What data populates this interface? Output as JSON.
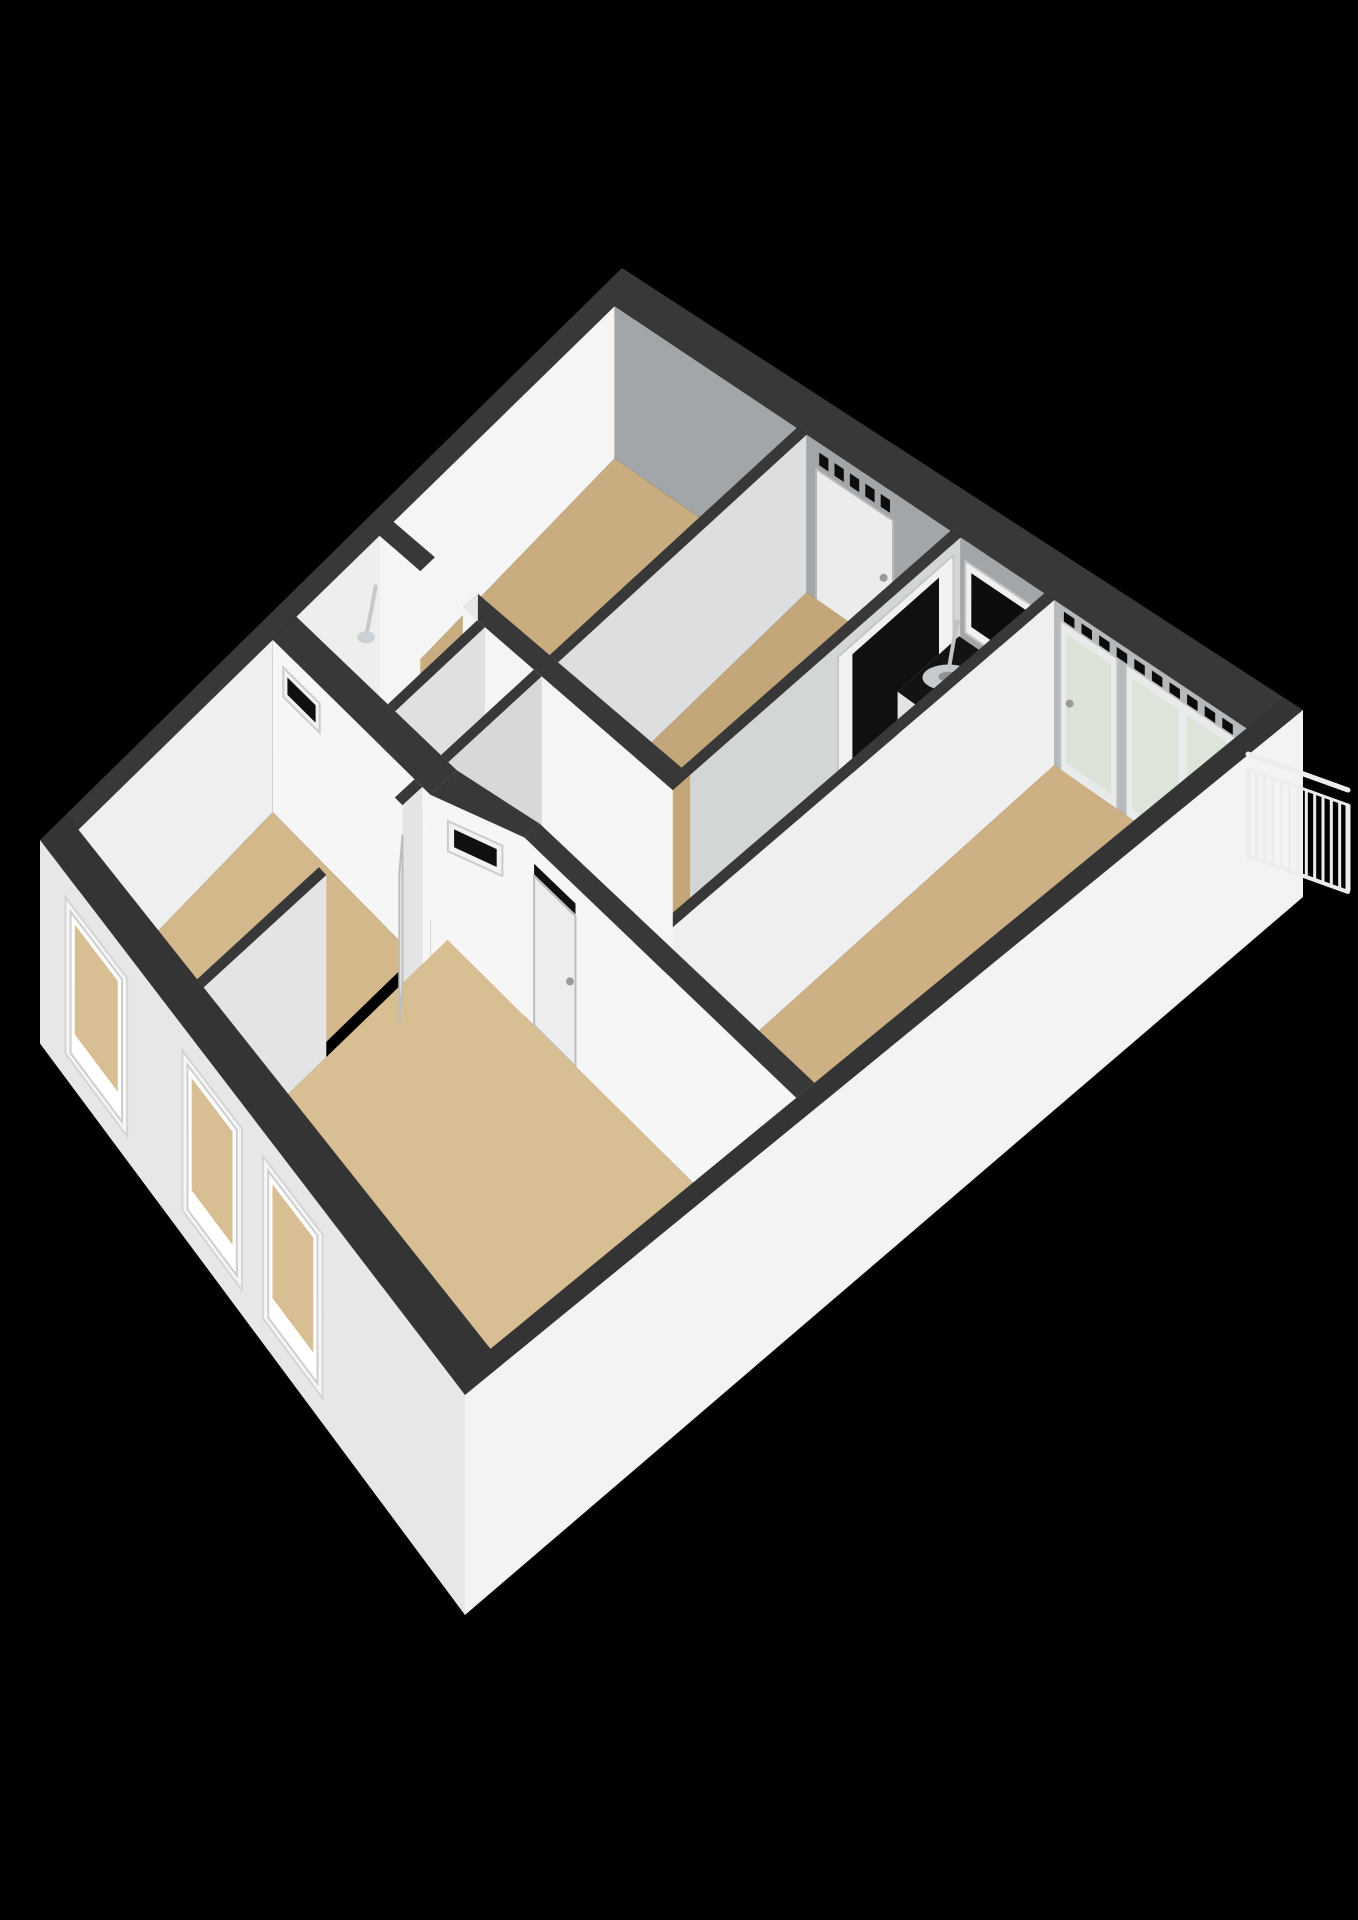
{
  "view": {
    "kind": "3d-floorplan-isometric-render",
    "canvas_width": 1358,
    "canvas_height": 1920,
    "background": "#000000"
  },
  "palette": {
    "wall_top": "#383838",
    "wall_top_exterior": "#343434",
    "wall_white": "#f5f5f5",
    "wall_gray": "#a3a6a8",
    "wall_gray_panel": "#b6b9bb",
    "facade_front": "#e7e7e7",
    "facade_side": "#f3f3f3",
    "floor_tan_back": "#c9ad80",
    "floor_tan_bedroom": "#cdb184",
    "floor_tan_front": "#d8bf93",
    "floor_shadow": "#171717",
    "counter_black": "#131313",
    "steel": "#c6cacc",
    "glass_dark": "#0d0d0d",
    "glass_light": "#dde4da",
    "door_white": "#ededed",
    "railing_white": "#ececec"
  },
  "projection": {
    "quad": {
      "A": [
        622,
        268
      ],
      "B": [
        1303,
        710
      ],
      "C": [
        465,
        1395
      ],
      "D": [
        40,
        840
      ]
    },
    "wall_heights": {
      "A": 150,
      "B": 170,
      "C": 200,
      "D": 185
    }
  },
  "scene": [
    {
      "t": "top",
      "n": "wall-top-nw",
      "r": [
        0,
        0,
        0.028,
        0.955
      ],
      "c": "#383838"
    },
    {
      "t": "top",
      "n": "wall-top-ne",
      "r": [
        0,
        0,
        1,
        0.045
      ],
      "c": "#383838"
    },
    {
      "t": "face",
      "n": "top-room-wall-nw",
      "a": [
        0.028,
        0.045
      ],
      "b": [
        0.028,
        0.42
      ],
      "z": [
        0,
        1
      ],
      "c": "#f5f5f5"
    },
    {
      "t": "face",
      "n": "top-room-wall-ne",
      "a": [
        0.028,
        0.045
      ],
      "b": [
        0.3,
        0.045
      ],
      "z": [
        0,
        1
      ],
      "c": "#a3a6a8"
    },
    {
      "t": "floor",
      "n": "top-room-floor",
      "r": [
        0.028,
        0.045,
        0.3,
        0.42
      ],
      "c": "#c9ad80"
    },
    {
      "t": "top",
      "n": "wall-top-w1",
      "r": [
        0.3,
        0.045,
        0.315,
        0.42
      ],
      "c": "#383838"
    },
    {
      "t": "face",
      "n": "wall-w1-east-face",
      "a": [
        0.315,
        0.045
      ],
      "b": [
        0.315,
        0.42
      ],
      "z": [
        0,
        1
      ],
      "c": "#dcdedf"
    },
    {
      "t": "face",
      "n": "entry-wall-ne",
      "a": [
        0.315,
        0.045
      ],
      "b": [
        0.53,
        0.045
      ],
      "z": [
        0,
        1
      ],
      "c": "#a3a6a8"
    },
    {
      "t": "face",
      "n": "entry-door",
      "a": [
        0.33,
        0.046
      ],
      "b": [
        0.445,
        0.046
      ],
      "z": [
        0.17,
        1
      ],
      "c": "#ececec",
      "s": "#b9b9b9"
    },
    {
      "t": "slots",
      "n": "entry-door-vent-slots",
      "a": [
        0.33,
        0.046
      ],
      "b": [
        0.445,
        0.046
      ],
      "z": [
        0.055,
        0.135
      ],
      "k": 5,
      "c": "#0d0d0d"
    },
    {
      "t": "disk",
      "n": "entry-door-handle",
      "at": [
        0.432,
        0.047
      ],
      "z": 0.56,
      "rx": 4,
      "ry": 4,
      "c": "#9a9a9a"
    },
    {
      "t": "floor",
      "n": "entry-hall-floor",
      "r": [
        0.315,
        0.045,
        0.53,
        0.42
      ],
      "c": "#c3a77a"
    },
    {
      "t": "top",
      "n": "wall-top-w3",
      "r": [
        0.53,
        0.045,
        0.545,
        0.42
      ],
      "c": "#383838"
    },
    {
      "t": "face",
      "n": "wall-w3-east-face",
      "a": [
        0.545,
        0.045
      ],
      "b": [
        0.545,
        0.42
      ],
      "z": [
        0,
        1
      ],
      "c": "#d3d6d7"
    },
    {
      "t": "face",
      "n": "kitchen-glass-door-frame",
      "a": [
        0.545,
        0.055
      ],
      "b": [
        0.545,
        0.215
      ],
      "z": [
        0.07,
        1
      ],
      "c": "#f1f1f1",
      "s": "#c6c6c6"
    },
    {
      "t": "face",
      "n": "kitchen-glass-door-glass",
      "a": [
        0.545,
        0.075
      ],
      "b": [
        0.545,
        0.195
      ],
      "z": [
        0.13,
        0.9
      ],
      "c": "#101010"
    },
    {
      "t": "face",
      "n": "kitchen-wall-ne",
      "a": [
        0.545,
        0.045
      ],
      "b": [
        0.67,
        0.045
      ],
      "z": [
        0,
        1
      ],
      "c": "#a3a6a8"
    },
    {
      "t": "face",
      "n": "kitchen-window-frame",
      "a": [
        0.553,
        0.046
      ],
      "b": [
        0.665,
        0.046
      ],
      "z": [
        0.12,
        0.56
      ],
      "c": "#f1f1f1",
      "s": "#c6c6c6"
    },
    {
      "t": "face",
      "n": "kitchen-window-glass",
      "a": [
        0.562,
        0.046
      ],
      "b": [
        0.656,
        0.046
      ],
      "z": [
        0.17,
        0.5
      ],
      "c": "#0d0d0d"
    },
    {
      "t": "floor",
      "n": "kitchen-floor",
      "r": [
        0.545,
        0.045,
        0.67,
        0.565
      ],
      "c": "#171717"
    },
    {
      "t": "slab",
      "n": "kitchen-counter",
      "r": [
        0.548,
        0.05,
        0.668,
        0.135
      ],
      "z": 0.58,
      "ct": "#131313",
      "cf": "#e4e4e4"
    },
    {
      "t": "disk",
      "n": "kitchen-sink-basin",
      "at": [
        0.578,
        0.092
      ],
      "z": 0.58,
      "rx": 26,
      "ry": 13,
      "c": "#c6cacc"
    },
    {
      "t": "disk",
      "n": "kitchen-sink-drain",
      "at": [
        0.578,
        0.092
      ],
      "z": 0.575,
      "rx": 10,
      "ry": 5,
      "c": "#8e9294"
    },
    {
      "t": "seg",
      "n": "kitchen-faucet-arm",
      "a": [
        0.561,
        0.065
      ],
      "b": [
        0.571,
        0.085
      ],
      "z": [
        0.4,
        0.57
      ],
      "c": "#c0c4c6",
      "w": 4
    },
    {
      "t": "disk",
      "n": "kitchen-faucet-head",
      "at": [
        0.561,
        0.065
      ],
      "z": 0.4,
      "rx": 4,
      "ry": 3,
      "c": "#c0c4c6"
    },
    {
      "t": "top",
      "n": "wall-top-w4",
      "r": [
        0.67,
        0.045,
        0.685,
        0.565
      ],
      "c": "#383838"
    },
    {
      "t": "face",
      "n": "wall-w4-east-face",
      "a": [
        0.685,
        0.045
      ],
      "b": [
        0.685,
        0.565
      ],
      "z": [
        0,
        1
      ],
      "c": "#efefef"
    },
    {
      "t": "face",
      "n": "bedroom1-wall-ne",
      "a": [
        0.685,
        0.045
      ],
      "b": [
        0.972,
        0.045
      ],
      "z": [
        0,
        1
      ],
      "c": "#b6b9bb"
    },
    {
      "t": "face",
      "n": "balcony-door-1-frame",
      "a": [
        0.695,
        0.046
      ],
      "b": [
        0.78,
        0.046
      ],
      "z": [
        0.09,
        1
      ],
      "c": "#e9ebeb",
      "s": "#c2c2c2"
    },
    {
      "t": "face",
      "n": "balcony-door-1-glass",
      "a": [
        0.704,
        0.046
      ],
      "b": [
        0.771,
        0.046
      ],
      "z": [
        0.15,
        0.93
      ],
      "c": "#dbe2d8"
    },
    {
      "t": "face",
      "n": "balcony-door-2-frame",
      "a": [
        0.793,
        0.046
      ],
      "b": [
        0.958,
        0.046
      ],
      "z": [
        0.09,
        1
      ],
      "c": "#e9ebeb",
      "s": "#c2c2c2"
    },
    {
      "t": "face",
      "n": "balcony-door-2-glass",
      "a": [
        0.802,
        0.046
      ],
      "b": [
        0.872,
        0.046
      ],
      "z": [
        0.15,
        0.93
      ],
      "c": "#dde4da"
    },
    {
      "t": "face",
      "n": "balcony-door-3-glass",
      "a": [
        0.884,
        0.046
      ],
      "b": [
        0.949,
        0.046
      ],
      "z": [
        0.15,
        0.93
      ],
      "c": "#dde4da"
    },
    {
      "t": "slots",
      "n": "balcony-transom-vents",
      "a": [
        0.695,
        0.046
      ],
      "b": [
        0.958,
        0.046
      ],
      "z": [
        0.025,
        0.085
      ],
      "k": 10,
      "c": "#0b0b0b"
    },
    {
      "t": "disk",
      "n": "balcony-door-handle",
      "at": [
        0.71,
        0.047
      ],
      "z": 0.55,
      "rx": 4,
      "ry": 4,
      "c": "#9a9a9a"
    },
    {
      "t": "floor",
      "n": "bedroom1-floor",
      "r": [
        0.685,
        0.045,
        0.972,
        0.565
      ],
      "c": "#cdb184"
    },
    {
      "t": "top",
      "n": "wall-top-w2-left",
      "r": [
        0.028,
        0.42,
        0.1,
        0.444
      ],
      "c": "#383838"
    },
    {
      "t": "top",
      "n": "wall-top-w2-right",
      "r": [
        0.175,
        0.42,
        0.545,
        0.444
      ],
      "c": "#383838"
    },
    {
      "t": "floor",
      "n": "top-room-doorway-gap",
      "r": [
        0.1,
        0.42,
        0.175,
        0.444
      ],
      "c": "#191919"
    },
    {
      "t": "face",
      "n": "wall-w2-left-face",
      "a": [
        0.028,
        0.444
      ],
      "b": [
        0.1,
        0.444
      ],
      "z": [
        0,
        1
      ],
      "c": "#f5f5f5"
    },
    {
      "t": "face",
      "n": "wall-w2-doorjamb",
      "a": [
        0.175,
        0.42
      ],
      "b": [
        0.175,
        0.444
      ],
      "z": [
        0,
        1
      ],
      "c": "#e8e8e8"
    },
    {
      "t": "face",
      "n": "wall-w2-right-face",
      "a": [
        0.175,
        0.444
      ],
      "b": [
        0.545,
        0.444
      ],
      "z": [
        0,
        1
      ],
      "c": "#f5f5f5"
    },
    {
      "t": "floor",
      "n": "hallway-floor",
      "r": [
        0.028,
        0.444,
        0.545,
        0.585
      ],
      "c": "#191919"
    },
    {
      "t": "face",
      "n": "bathroom-wall-nw",
      "a": [
        0.028,
        0.444
      ],
      "b": [
        0.028,
        0.585
      ],
      "z": [
        0,
        1
      ],
      "c": "#eeeeee"
    },
    {
      "t": "floor",
      "n": "bathroom-floor",
      "r": [
        0.028,
        0.444,
        0.2,
        0.585
      ],
      "c": "#e7e7e7"
    },
    {
      "t": "seg",
      "n": "shower-arm",
      "a": [
        0.038,
        0.46
      ],
      "b": [
        0.058,
        0.495
      ],
      "z": [
        0.22,
        0.34
      ],
      "c": "#c6cacc",
      "w": 4
    },
    {
      "t": "disk",
      "n": "shower-head",
      "at": [
        0.058,
        0.495
      ],
      "z": 0.34,
      "rx": 9,
      "ry": 6,
      "c": "#cdd1d3"
    },
    {
      "t": "top",
      "n": "wall-top-w9",
      "r": [
        0.2,
        0.444,
        0.214,
        0.585
      ],
      "c": "#383838"
    },
    {
      "t": "face",
      "n": "wall-w9-east-face",
      "a": [
        0.214,
        0.444
      ],
      "b": [
        0.214,
        0.585
      ],
      "z": [
        0,
        1
      ],
      "c": "#e0e0e0"
    },
    {
      "t": "floor",
      "n": "wc-floor",
      "r": [
        0.214,
        0.444,
        0.3,
        0.585
      ],
      "c": "#e7e7e7"
    },
    {
      "t": "face",
      "n": "toilet-tank",
      "a": [
        0.238,
        0.452
      ],
      "b": [
        0.272,
        0.452
      ],
      "z": [
        0.48,
        0.75
      ],
      "c": "#f2f2f2"
    },
    {
      "t": "disk",
      "n": "toilet-bowl",
      "at": [
        0.255,
        0.49
      ],
      "z": 0.75,
      "rx": 13,
      "ry": 8,
      "c": "#fafafa"
    },
    {
      "t": "top",
      "n": "wall-top-w10",
      "r": [
        0.3,
        0.444,
        0.314,
        0.585
      ],
      "c": "#383838"
    },
    {
      "t": "face",
      "n": "wall-w10-east-face",
      "a": [
        0.314,
        0.444
      ],
      "b": [
        0.314,
        0.585
      ],
      "z": [
        0,
        1
      ],
      "c": "#d8d8d8"
    },
    {
      "t": "top",
      "n": "wall-top-w6",
      "r": [
        0.028,
        0.585,
        0.33,
        0.625
      ],
      "c": "#383838"
    },
    {
      "t": "face",
      "n": "hallway-south-wall",
      "a": [
        0.028,
        0.625
      ],
      "b": [
        0.33,
        0.625
      ],
      "z": [
        0,
        1
      ],
      "c": "#f6f6f6"
    },
    {
      "t": "face",
      "n": "hall-transom-1-frame",
      "a": [
        0.048,
        0.625
      ],
      "b": [
        0.118,
        0.625
      ],
      "z": [
        0.1,
        0.27
      ],
      "c": "#f2f2f2",
      "s": "#cccccc"
    },
    {
      "t": "face",
      "n": "hall-transom-1-glass",
      "a": [
        0.056,
        0.625
      ],
      "b": [
        0.11,
        0.625
      ],
      "z": [
        0.135,
        0.235
      ],
      "c": "#101010"
    },
    {
      "t": "poly",
      "n": "wall-top-w7-angled",
      "p": [
        [
          0.33,
          0.585
        ],
        [
          0.46,
          0.565
        ],
        [
          0.46,
          0.587
        ],
        [
          0.33,
          0.625
        ]
      ],
      "c": "#383838"
    },
    {
      "t": "face",
      "n": "hallway-angled-wall",
      "a": [
        0.33,
        0.625
      ],
      "b": [
        0.46,
        0.587
      ],
      "z": [
        0,
        1
      ],
      "c": "#f6f6f6"
    },
    {
      "t": "face",
      "n": "hall-transom-2-frame",
      "a": [
        0.355,
        0.618
      ],
      "b": [
        0.43,
        0.596
      ],
      "z": [
        0.1,
        0.27
      ],
      "c": "#f2f2f2",
      "s": "#cccccc"
    },
    {
      "t": "face",
      "n": "hall-transom-2-glass",
      "a": [
        0.363,
        0.615
      ],
      "b": [
        0.422,
        0.598
      ],
      "z": [
        0.135,
        0.235
      ],
      "c": "#101010"
    },
    {
      "t": "top",
      "n": "wall-top-w5",
      "r": [
        0.46,
        0.565,
        0.972,
        0.587
      ],
      "c": "#383838"
    },
    {
      "t": "face",
      "n": "living-north-wall",
      "a": [
        0.46,
        0.587
      ],
      "b": [
        0.972,
        0.587
      ],
      "z": [
        0,
        1
      ],
      "c": "#f6f6f6"
    },
    {
      "t": "face",
      "n": "living-door-transom",
      "a": [
        0.478,
        0.587
      ],
      "b": [
        0.556,
        0.587
      ],
      "z": [
        0.095,
        0.155
      ],
      "c": "#111111"
    },
    {
      "t": "face",
      "n": "living-door",
      "a": [
        0.478,
        0.587
      ],
      "b": [
        0.556,
        0.587
      ],
      "z": [
        0.165,
        1
      ],
      "c": "#ededed",
      "s": "#bdbdbd"
    },
    {
      "t": "disk",
      "n": "living-door-handle",
      "at": [
        0.547,
        0.588
      ],
      "z": 0.55,
      "rx": 4,
      "ry": 4,
      "c": "#9a9a9a"
    },
    {
      "t": "floor",
      "n": "living-room-floor",
      "r": [
        0.315,
        0.587,
        0.972,
        0.955
      ],
      "c": "#d8bf93"
    },
    {
      "t": "face",
      "n": "bedroom3-wall-nw",
      "a": [
        0.028,
        0.625
      ],
      "b": [
        0.028,
        0.955
      ],
      "z": [
        0,
        1
      ],
      "c": "#efefef"
    },
    {
      "t": "floor",
      "n": "bedroom3-floor",
      "r": [
        0.028,
        0.625,
        0.3,
        0.955
      ],
      "c": "#d3b88c"
    },
    {
      "t": "top",
      "n": "wall-top-w8-upper",
      "r": [
        0.3,
        0.625,
        0.315,
        0.655
      ],
      "c": "#383838"
    },
    {
      "t": "top",
      "n": "wall-top-w8-lower",
      "r": [
        0.3,
        0.77,
        0.315,
        0.955
      ],
      "c": "#383838"
    },
    {
      "t": "face",
      "n": "wall-w8-upper-face",
      "a": [
        0.315,
        0.625
      ],
      "b": [
        0.315,
        0.655
      ],
      "z": [
        0,
        1
      ],
      "c": "#e4e4e4"
    },
    {
      "t": "face",
      "n": "wall-w8-lower-face",
      "a": [
        0.315,
        0.77
      ],
      "b": [
        0.315,
        0.955
      ],
      "z": [
        0,
        1
      ],
      "c": "#e4e4e4"
    },
    {
      "t": "face",
      "n": "bedroom3-door-leaf",
      "a": [
        0.315,
        0.655
      ],
      "b": [
        0.352,
        0.688
      ],
      "z": [
        0.165,
        1
      ],
      "c": "#ededed",
      "s": "#bdbdbd"
    },
    {
      "t": "top",
      "n": "wall-top-se",
      "r": [
        0.972,
        0,
        1,
        1
      ],
      "c": "#343434"
    },
    {
      "t": "top",
      "n": "wall-top-sw",
      "r": [
        0,
        0.955,
        1,
        1
      ],
      "c": "#343434"
    },
    {
      "t": "face",
      "n": "facade-sw",
      "a": [
        0,
        1
      ],
      "b": [
        1,
        1
      ],
      "z": [
        0,
        1.1
      ],
      "c": "#e7e7e7"
    },
    {
      "t": "face",
      "n": "facade-window-1-frame",
      "a": [
        0.06,
        1
      ],
      "b": [
        0.205,
        1
      ],
      "z": [
        0.13,
        0.97
      ],
      "c": "#f6f6f6",
      "s": "#d5d5d5"
    },
    {
      "t": "face",
      "n": "facade-window-1-jamb",
      "a": [
        0.072,
        1
      ],
      "b": [
        0.193,
        1
      ],
      "z": [
        0.17,
        0.93
      ],
      "c": "#ffffff",
      "s": "#cfcfcf"
    },
    {
      "t": "face",
      "n": "facade-window-1-opening",
      "a": [
        0.082,
        1
      ],
      "b": [
        0.183,
        1
      ],
      "z": [
        0.21,
        0.8
      ],
      "c": "#d8bf93"
    },
    {
      "t": "face",
      "n": "facade-window-2-frame",
      "a": [
        0.335,
        1
      ],
      "b": [
        0.475,
        1
      ],
      "z": [
        0.13,
        0.97
      ],
      "c": "#f6f6f6",
      "s": "#d5d5d5"
    },
    {
      "t": "face",
      "n": "facade-window-2-jamb",
      "a": [
        0.347,
        1
      ],
      "b": [
        0.463,
        1
      ],
      "z": [
        0.17,
        0.93
      ],
      "c": "#ffffff",
      "s": "#cfcfcf"
    },
    {
      "t": "face",
      "n": "facade-window-2-opening",
      "a": [
        0.357,
        1
      ],
      "b": [
        0.453,
        1
      ],
      "z": [
        0.21,
        0.8
      ],
      "c": "#d8bf93"
    },
    {
      "t": "face",
      "n": "facade-window-3-frame",
      "a": [
        0.525,
        1
      ],
      "b": [
        0.665,
        1
      ],
      "z": [
        0.13,
        0.97
      ],
      "c": "#f6f6f6",
      "s": "#d5d5d5"
    },
    {
      "t": "face",
      "n": "facade-window-3-jamb",
      "a": [
        0.537,
        1
      ],
      "b": [
        0.653,
        1
      ],
      "z": [
        0.17,
        0.93
      ],
      "c": "#ffffff",
      "s": "#cfcfcf"
    },
    {
      "t": "face",
      "n": "facade-window-3-opening",
      "a": [
        0.547,
        1
      ],
      "b": [
        0.643,
        1
      ],
      "z": [
        0.21,
        0.8
      ],
      "c": "#d8bf93"
    },
    {
      "t": "face",
      "n": "facade-se",
      "a": [
        1,
        1
      ],
      "b": [
        1,
        0
      ],
      "z": [
        0,
        1.1
      ],
      "c": "#f3f3f3"
    },
    {
      "t": "rail",
      "n": "balcony-railing",
      "x1": 1248,
      "y1": 754,
      "x2": 1348,
      "y2": 790,
      "drop": 102,
      "bars": 12,
      "c": "#ececec"
    }
  ]
}
